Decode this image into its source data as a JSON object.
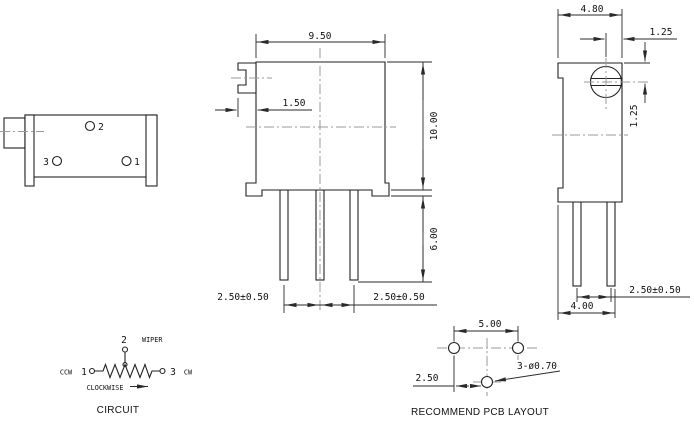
{
  "meta": {
    "bg": "#ffffff",
    "line_color": "#222222",
    "centerline_color": "#9a9a9a"
  },
  "side_view": {
    "pin2": "2",
    "pin3": "3",
    "pin1": "1"
  },
  "front_view": {
    "width": "9.50",
    "slot_width": "1.50",
    "height": "10.00",
    "pin_length": "6.00",
    "pin_pitch_left": "2.50±0.50",
    "pin_pitch_right": "2.50±0.50"
  },
  "profile_view": {
    "depth": "4.80",
    "screw_offset_h": "1.25",
    "screw_offset_v": "1.25",
    "pin_pitch": "2.50±0.50",
    "footprint_width": "4.00"
  },
  "circuit": {
    "pin2": "2",
    "wiper": "WIPER",
    "ccw": "CCW",
    "pin1": "1",
    "pin3": "3",
    "cw": "CW",
    "direction": "CLOCKWISE",
    "caption": "CIRCUIT"
  },
  "pcb": {
    "hole_pitch": "5.00",
    "hole_offset": "2.50",
    "hole_spec": "3-ø0.70",
    "caption": "RECOMMEND PCB LAYOUT"
  }
}
